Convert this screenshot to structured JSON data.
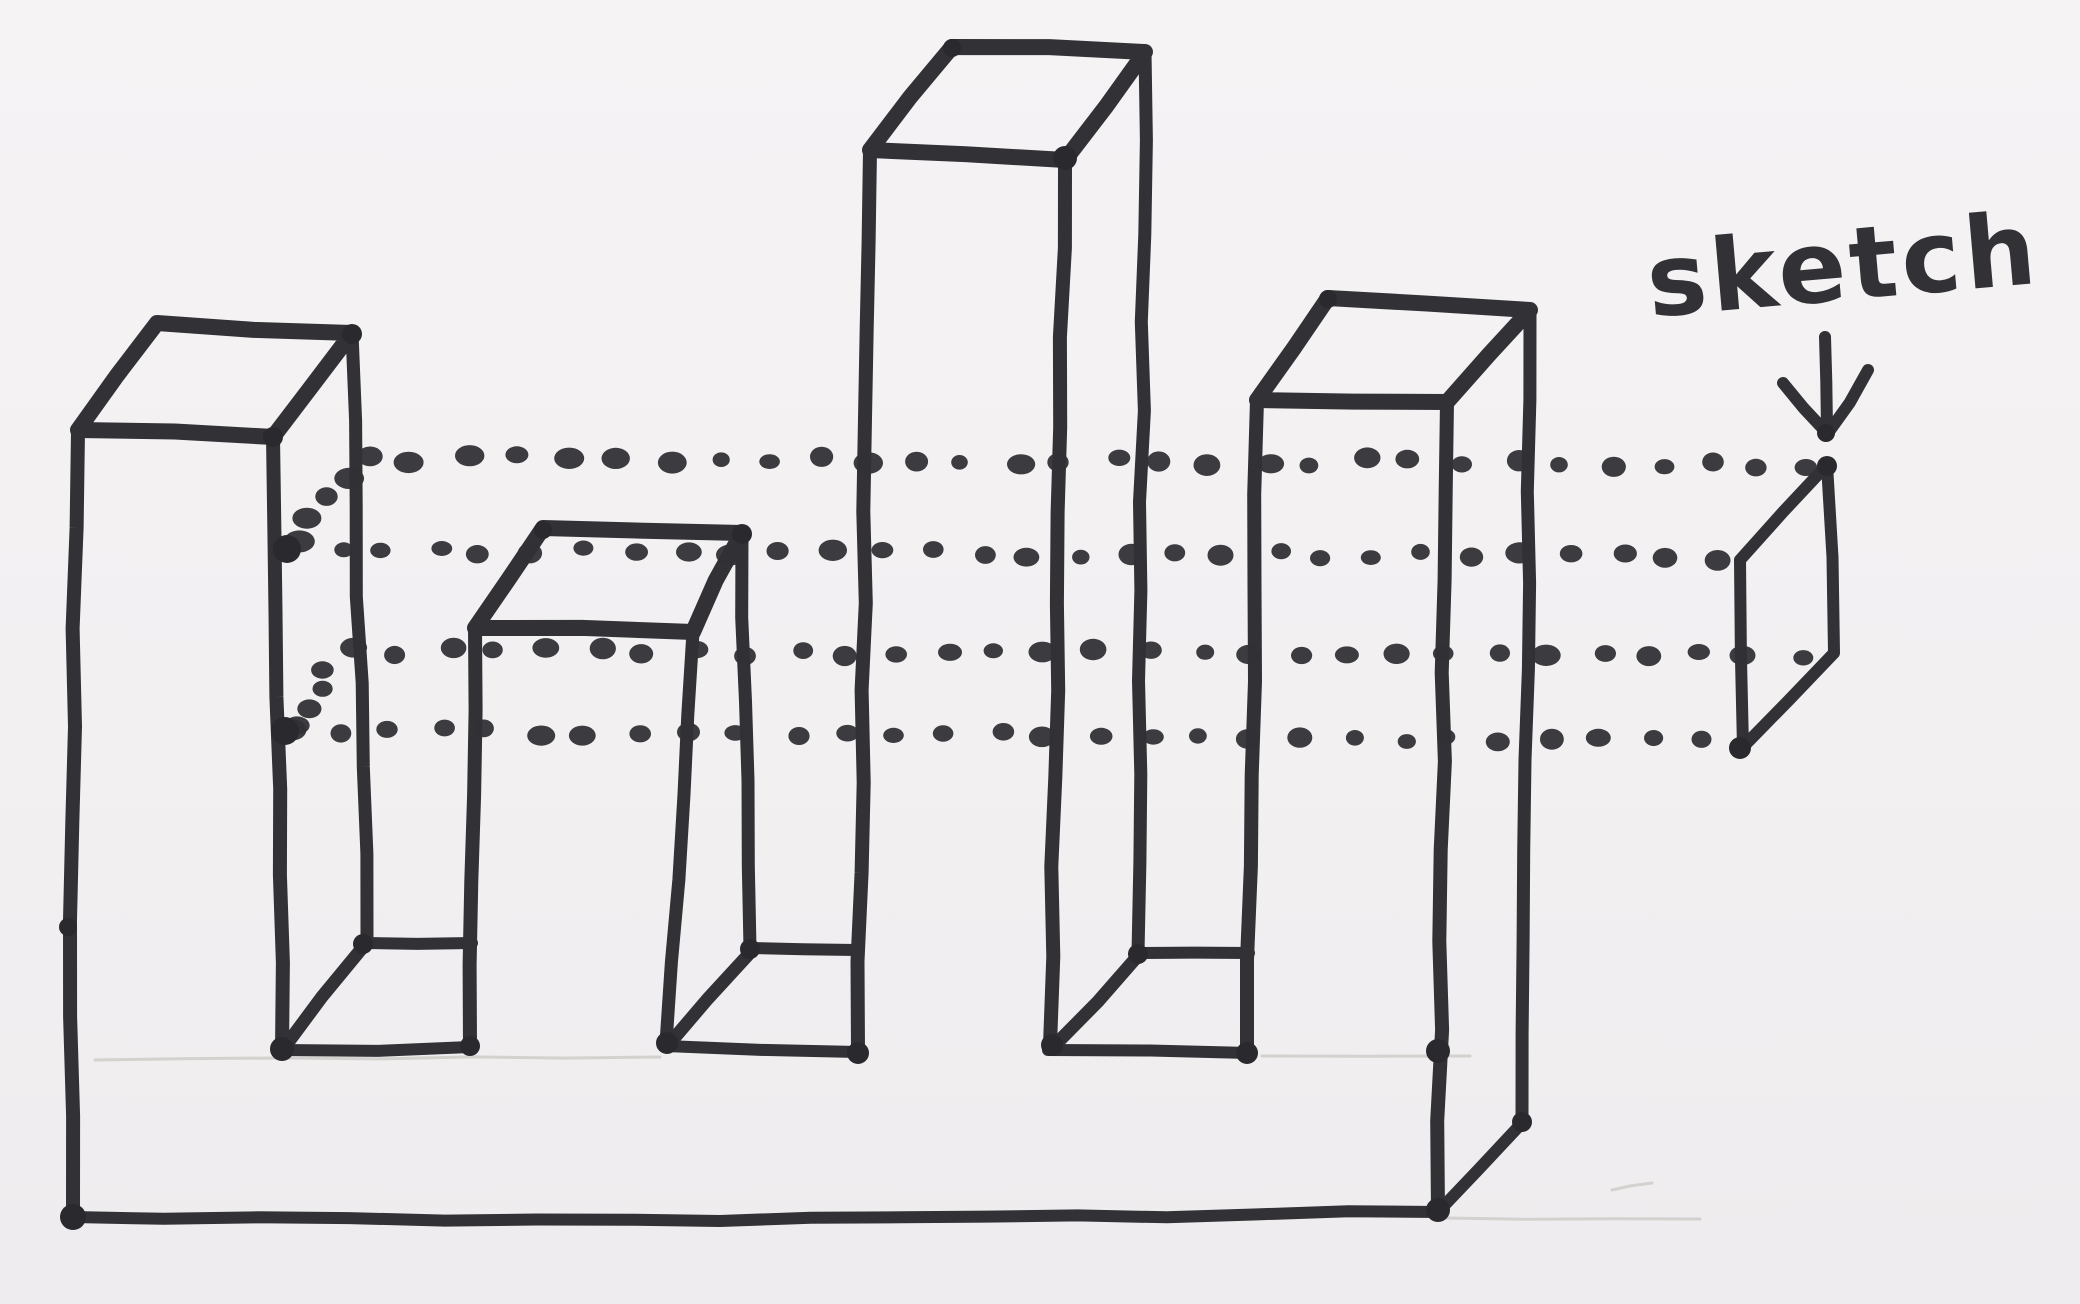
{
  "annotation": {
    "label": "sketch",
    "arrow_direction": "down"
  },
  "palette": {
    "ink": "#323136",
    "ink_dark": "#2a292e",
    "pencil": "#cdc9c5",
    "paper": "#f3f1f2"
  },
  "figure": {
    "viewbox": "0 0 2080 1304",
    "kind": "hand-drawn-extrusion-diagram",
    "marker_strokes": [
      {
        "name": "slab-left-edge",
        "w": 14,
        "points": [
          [
            78,
            431
          ],
          [
            70,
            920
          ],
          [
            73,
            1217
          ]
        ]
      },
      {
        "name": "slab-bottom-edge",
        "w": 12,
        "points": [
          [
            73,
            1217
          ],
          [
            720,
            1221
          ],
          [
            1438,
            1212
          ]
        ]
      },
      {
        "name": "slab-right-depth-edge",
        "w": 12,
        "points": [
          [
            1438,
            1212
          ],
          [
            1522,
            1123
          ]
        ]
      },
      {
        "name": "tower1-top-face",
        "w": 16,
        "points": [
          [
            78,
            430
          ],
          [
            157,
            323
          ],
          [
            352,
            333
          ],
          [
            273,
            437
          ],
          [
            78,
            430
          ]
        ]
      },
      {
        "name": "tower1-front-right-edge",
        "w": 14,
        "points": [
          [
            273,
            437
          ],
          [
            282,
            1049
          ]
        ]
      },
      {
        "name": "tower1-back-right-edge",
        "w": 13,
        "points": [
          [
            352,
            333
          ],
          [
            367,
            943
          ]
        ]
      },
      {
        "name": "notch1-floor-front-edge",
        "w": 12,
        "points": [
          [
            282,
            1050
          ],
          [
            470,
            1047
          ]
        ]
      },
      {
        "name": "notch1-floor-back-edge",
        "w": 12,
        "points": [
          [
            367,
            943
          ],
          [
            472,
            943
          ]
        ]
      },
      {
        "name": "notch1-floor-depth-edge",
        "w": 13,
        "points": [
          [
            363,
            947
          ],
          [
            284,
            1048
          ]
        ]
      },
      {
        "name": "tower2-top-face",
        "w": 16,
        "points": [
          [
            475,
            628
          ],
          [
            543,
            528
          ],
          [
            742,
            533
          ],
          [
            693,
            632
          ],
          [
            475,
            628
          ]
        ]
      },
      {
        "name": "tower2-front-left-edge",
        "w": 14,
        "points": [
          [
            475,
            628
          ],
          [
            470,
            1047
          ]
        ]
      },
      {
        "name": "tower2-front-right-edge",
        "w": 13,
        "points": [
          [
            693,
            632
          ],
          [
            666,
            1043
          ]
        ]
      },
      {
        "name": "tower2-back-right-edge",
        "w": 13,
        "points": [
          [
            742,
            533
          ],
          [
            750,
            948
          ]
        ]
      },
      {
        "name": "notch2-floor-front-edge",
        "w": 12,
        "points": [
          [
            666,
            1046
          ],
          [
            858,
            1052
          ]
        ]
      },
      {
        "name": "notch2-floor-back-edge",
        "w": 12,
        "points": [
          [
            750,
            948
          ],
          [
            856,
            950
          ]
        ]
      },
      {
        "name": "notch2-floor-depth-edge",
        "w": 13,
        "points": [
          [
            748,
            955
          ],
          [
            670,
            1043
          ]
        ]
      },
      {
        "name": "tower3-top-face",
        "w": 16,
        "points": [
          [
            870,
            150
          ],
          [
            952,
            47
          ],
          [
            1145,
            52
          ],
          [
            1065,
            160
          ],
          [
            870,
            150
          ]
        ]
      },
      {
        "name": "tower3-front-left-edge",
        "w": 14,
        "points": [
          [
            870,
            150
          ],
          [
            858,
            1052
          ]
        ]
      },
      {
        "name": "tower3-front-right-edge",
        "w": 14,
        "points": [
          [
            1065,
            160
          ],
          [
            1050,
            1045
          ]
        ]
      },
      {
        "name": "tower3-back-right-edge",
        "w": 13,
        "points": [
          [
            1145,
            52
          ],
          [
            1138,
            953
          ]
        ]
      },
      {
        "name": "notch3-floor-front-edge",
        "w": 12,
        "points": [
          [
            1048,
            1050
          ],
          [
            1249,
            1053
          ]
        ]
      },
      {
        "name": "notch3-floor-back-edge",
        "w": 12,
        "points": [
          [
            1138,
            953
          ],
          [
            1249,
            953
          ]
        ]
      },
      {
        "name": "notch3-floor-depth-edge",
        "w": 13,
        "points": [
          [
            1136,
            958
          ],
          [
            1055,
            1045
          ]
        ]
      },
      {
        "name": "tower4-top-face",
        "w": 16,
        "points": [
          [
            1257,
            400
          ],
          [
            1328,
            298
          ],
          [
            1530,
            310
          ],
          [
            1447,
            402
          ],
          [
            1257,
            400
          ]
        ]
      },
      {
        "name": "tower4-front-left-edge",
        "w": 14,
        "points": [
          [
            1257,
            400
          ],
          [
            1247,
            1053
          ]
        ]
      },
      {
        "name": "tower4-front-right-edge",
        "w": 14,
        "points": [
          [
            1447,
            402
          ],
          [
            1438,
            1212
          ]
        ]
      },
      {
        "name": "tower4-back-right-edge",
        "w": 13,
        "points": [
          [
            1530,
            310
          ],
          [
            1522,
            1123
          ]
        ]
      },
      {
        "name": "sketch-profile-outline",
        "w": 12,
        "points": [
          [
            1740,
            560
          ],
          [
            1827,
            465
          ],
          [
            1834,
            653
          ],
          [
            1743,
            747
          ],
          [
            1740,
            560
          ]
        ]
      },
      {
        "name": "label-arrow-shaft",
        "w": 12,
        "points": [
          [
            1825,
            337
          ],
          [
            1827,
            430
          ]
        ]
      },
      {
        "name": "label-arrow-head-left",
        "w": 12,
        "points": [
          [
            1783,
            383
          ],
          [
            1826,
            432
          ]
        ]
      },
      {
        "name": "label-arrow-head-right",
        "w": 12,
        "points": [
          [
            1868,
            370
          ],
          [
            1828,
            433
          ]
        ]
      }
    ],
    "pencil_strokes": [
      {
        "name": "pencil-guide-slab-top-left",
        "points": [
          [
            95,
            1060
          ],
          [
            660,
            1057
          ]
        ]
      },
      {
        "name": "pencil-guide-slab-top-right",
        "points": [
          [
            1262,
            1056
          ],
          [
            1470,
            1056
          ]
        ]
      },
      {
        "name": "pencil-guide-slab-bottom-right",
        "points": [
          [
            1445,
            1218
          ],
          [
            1700,
            1219
          ]
        ]
      },
      {
        "name": "pencil-smudge",
        "points": [
          [
            1612,
            1190
          ],
          [
            1652,
            1183
          ]
        ]
      }
    ],
    "dot_rows": [
      {
        "name": "extrusion-guide-row-1",
        "from": [
          365,
          458
        ],
        "to": [
          1813,
          464
        ],
        "n": 30
      },
      {
        "name": "extrusion-guide-row-2",
        "from": [
          287,
          549
        ],
        "to": [
          1720,
          558
        ],
        "n": 30
      },
      {
        "name": "extrusion-guide-row-3",
        "from": [
          347,
          651
        ],
        "to": [
          1798,
          654
        ],
        "n": 30
      },
      {
        "name": "extrusion-guide-row-4",
        "from": [
          285,
          731
        ],
        "to": [
          1706,
          740
        ],
        "n": 29
      },
      {
        "name": "far-end-profile-top-edge-dotted",
        "from": [
          346,
          475
        ],
        "to": [
          297,
          543
        ],
        "n": 4
      },
      {
        "name": "far-end-profile-bottom-edge-dotted",
        "from": [
          330,
          669
        ],
        "to": [
          297,
          722
        ],
        "n": 4
      }
    ],
    "ink_blobs": [
      [
        73,
        1217,
        13
      ],
      [
        68,
        927,
        9
      ],
      [
        287,
        549,
        14
      ],
      [
        285,
        731,
        14
      ],
      [
        282,
        1049,
        12
      ],
      [
        363,
        944,
        10
      ],
      [
        470,
        1046,
        10
      ],
      [
        667,
        1043,
        11
      ],
      [
        750,
        949,
        10
      ],
      [
        858,
        1053,
        11
      ],
      [
        1052,
        1045,
        11
      ],
      [
        1138,
        954,
        10
      ],
      [
        1247,
        1053,
        11
      ],
      [
        1438,
        1051,
        12
      ],
      [
        1438,
        1210,
        12
      ],
      [
        1522,
        1122,
        10
      ],
      [
        1065,
        158,
        12
      ],
      [
        352,
        334,
        10
      ],
      [
        273,
        437,
        10
      ],
      [
        543,
        530,
        9
      ],
      [
        742,
        534,
        10
      ],
      [
        952,
        48,
        9
      ],
      [
        1328,
        299,
        9
      ],
      [
        1827,
        466,
        10
      ],
      [
        1740,
        748,
        11
      ],
      [
        1826,
        433,
        9
      ]
    ],
    "label_pos": {
      "x": 1645,
      "y": 300,
      "size": 100,
      "rotate": -5
    }
  }
}
